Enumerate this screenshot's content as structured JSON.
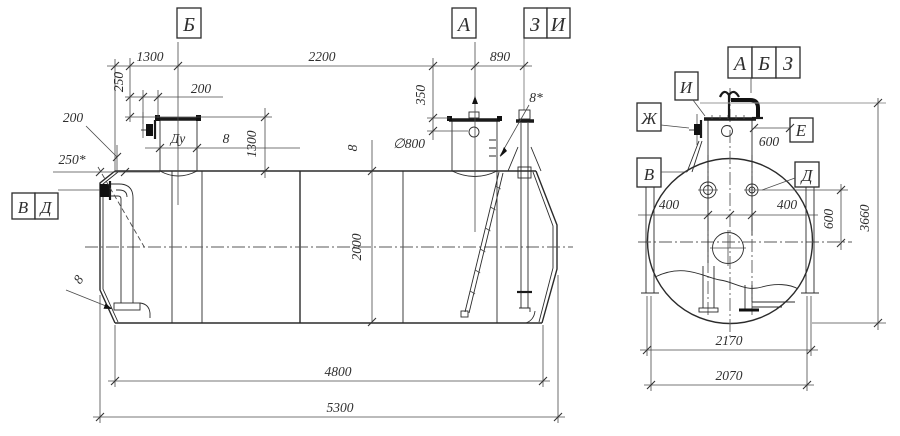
{
  "side_view": {
    "sections": {
      "b": "Б",
      "a": "А",
      "z": "З",
      "i": "И"
    },
    "nozzles": {
      "v": "В",
      "d": "Д"
    },
    "dims": {
      "top1": "1300",
      "top2": "2200",
      "top3": "890",
      "v250": "250",
      "h200": "200",
      "leader200": "200",
      "ref250": "250*",
      "du": "Ду",
      "neck8": "8",
      "v1300": "1300",
      "v350": "350",
      "dia800": "∅800",
      "shell8": "8",
      "star8": "8*",
      "v2000": "2000",
      "head8": "8",
      "len4800": "4800",
      "len5300": "5300"
    }
  },
  "end_view": {
    "sections": {
      "a": "А",
      "b": "Б",
      "z": "З"
    },
    "labels": {
      "i": "И",
      "zh": "Ж",
      "v": "В",
      "e": "Е",
      "d": "Д"
    },
    "dims": {
      "e600": "600",
      "l400": "400",
      "r400": "400",
      "v600": "600",
      "v3660": "3660",
      "w2170": "2170",
      "w2070": "2070"
    }
  }
}
